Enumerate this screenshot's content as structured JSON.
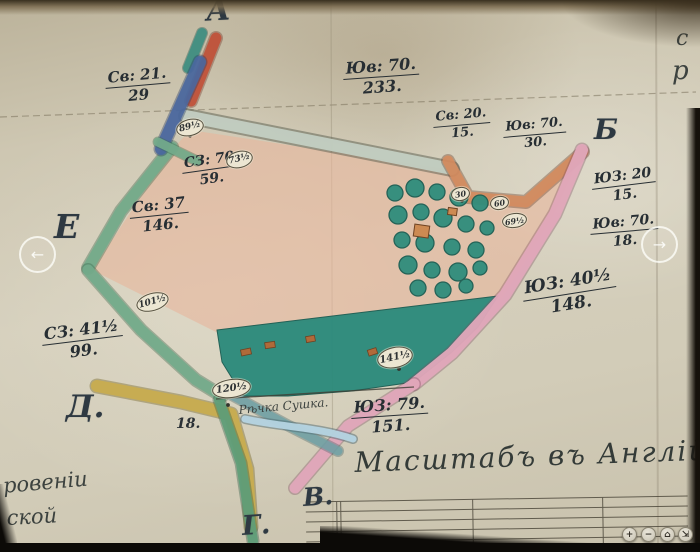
{
  "viewer": {
    "nav": {
      "prev_icon": "←",
      "next_icon": "→"
    },
    "zoombar": {
      "zoom_in_icon": "+",
      "zoom_out_icon": "−",
      "home_icon": "⌂",
      "fullscreen_icon": "⇲"
    }
  },
  "map": {
    "corners": [
      "А",
      "Б",
      "Е",
      "Д.",
      "В.",
      "Г."
    ],
    "measurements": [
      {
        "dir": "Св: 21.",
        "len": "29"
      },
      {
        "dir": "Юв: 70.",
        "len": "233."
      },
      {
        "dir": "Св: 20.",
        "len": "15."
      },
      {
        "dir": "Юв: 70.",
        "len": "30."
      },
      {
        "dir": "СЗ: 70",
        "len": "59."
      },
      {
        "dir": "Св: 37",
        "len": "146."
      },
      {
        "dir": "ЮЗ: 20",
        "len": "15."
      },
      {
        "dir": "Юв: 70.",
        "len": "18."
      },
      {
        "dir": "СЗ: 41½",
        "len": "99."
      },
      {
        "dir": "ЮЗ: 40½",
        "len": "148."
      },
      {
        "dir": "ЮЗ: 79.",
        "len": "151."
      }
    ],
    "stations": [
      "89½",
      "73½",
      "101½",
      "120½",
      "141½",
      "30",
      "60",
      "69½"
    ],
    "river_label": "Рѣчка Сушка.",
    "loose_number": "18.",
    "scale_caption": "Масштабъ въ Англійск",
    "marginalia": {
      "left_line1": "ровеніи",
      "left_line2": "ской",
      "right_line1": "с",
      "right_line2": "р"
    }
  },
  "colors": {
    "paper": "#d0c9b6",
    "ink": "#2b3136",
    "field_pink": "#e7b79d",
    "meadow_teal": "#2b8a7b",
    "band_pink": "#e2a8bb",
    "band_salmon": "#d58c5e",
    "band_red": "#c25138",
    "band_blue": "#4a68a0",
    "band_green": "#74ab8b",
    "band_yellow": "#c9ad4e",
    "road_sage": "#c3cfc2",
    "stream_blue": "#b5d4e2"
  }
}
